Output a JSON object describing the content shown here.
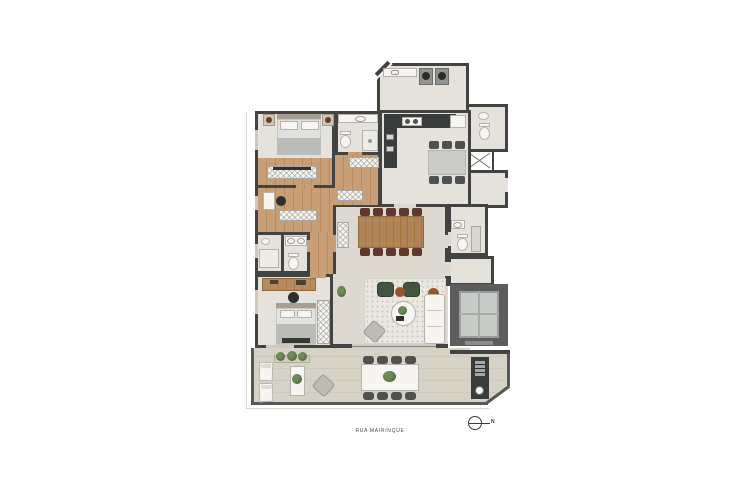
{
  "labels": {
    "street": "RUA MAIRINQUE",
    "north": "N"
  },
  "icons": {
    "north_arrow": "circle-with-east-line"
  },
  "palette": {
    "wall": "#424443",
    "floor": "#e5e2db",
    "floorLiving": "#ddd9d1",
    "wood": "#c79e75",
    "woodLine": "#b78c63",
    "terrace": "#d6d3c6",
    "rug": "#eae7e0",
    "white": "#f6f5f1",
    "stone": "#cbcbc7",
    "chairDark": "#4e5150",
    "maroon": "#5f382e",
    "greenDark": "#44543f",
    "greenPlant": "#5c7547",
    "rust": "#99532f",
    "grayFurn": "#bcbbb4",
    "steel": "#a3a8a6",
    "shaft": "#5c5e5d",
    "car": "#c8cac7",
    "glass": "#ccc9c2",
    "lotline": "#d9d8d3",
    "text": "#4a4a4a"
  }
}
